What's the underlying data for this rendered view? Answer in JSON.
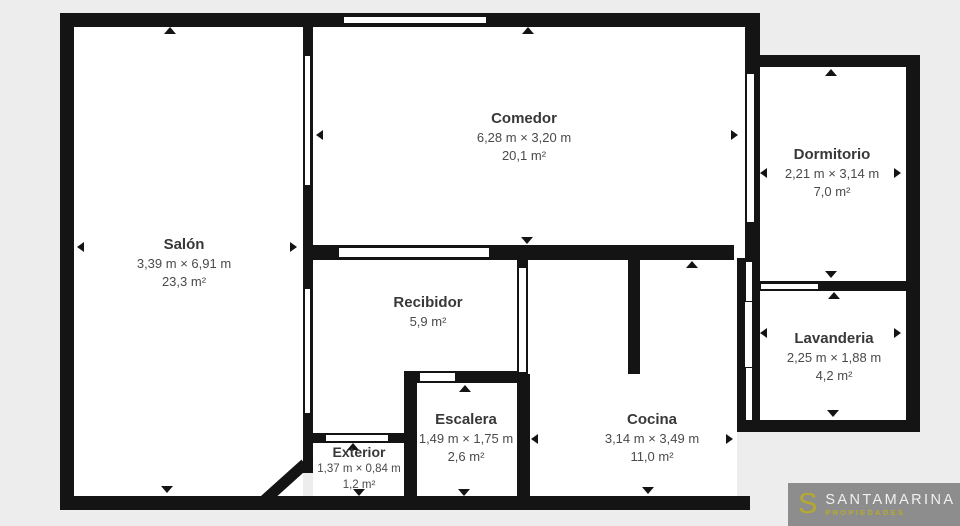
{
  "plan": {
    "background_color": "#ededed",
    "wall_color": "#141414",
    "room_fill": "#ffffff",
    "rooms": [
      {
        "id": "salon",
        "name": "Salón",
        "dimensions": "3,39 m × 6,91 m",
        "area": "23,3 m²"
      },
      {
        "id": "comedor",
        "name": "Comedor",
        "dimensions": "6,28 m × 3,20 m",
        "area": "20,1 m²"
      },
      {
        "id": "dormitorio",
        "name": "Dormitorio",
        "dimensions": "2,21 m × 3,14 m",
        "area": "7,0 m²"
      },
      {
        "id": "recibidor",
        "name": "Recibidor",
        "area": "5,9 m²"
      },
      {
        "id": "lavanderia",
        "name": "Lavanderia",
        "dimensions": "2,25 m × 1,88 m",
        "area": "4,2 m²"
      },
      {
        "id": "escalera",
        "name": "Escalera",
        "dimensions": "1,49 m × 1,75 m",
        "area": "2,6 m²"
      },
      {
        "id": "cocina",
        "name": "Cocina",
        "dimensions": "3,14 m × 3,49 m",
        "area": "11,0 m²"
      },
      {
        "id": "exterior",
        "name": "Exterior",
        "dimensions": "1,37 m × 0,84 m",
        "area": "1,2 m²"
      }
    ]
  },
  "logo": {
    "monogram": "S",
    "brand": "SANTAMARINA",
    "tagline": "PROPIEDADES",
    "background_color": "#8d8d8d",
    "accent_color": "#b5a92f",
    "brand_color": "#f0f0f0"
  }
}
